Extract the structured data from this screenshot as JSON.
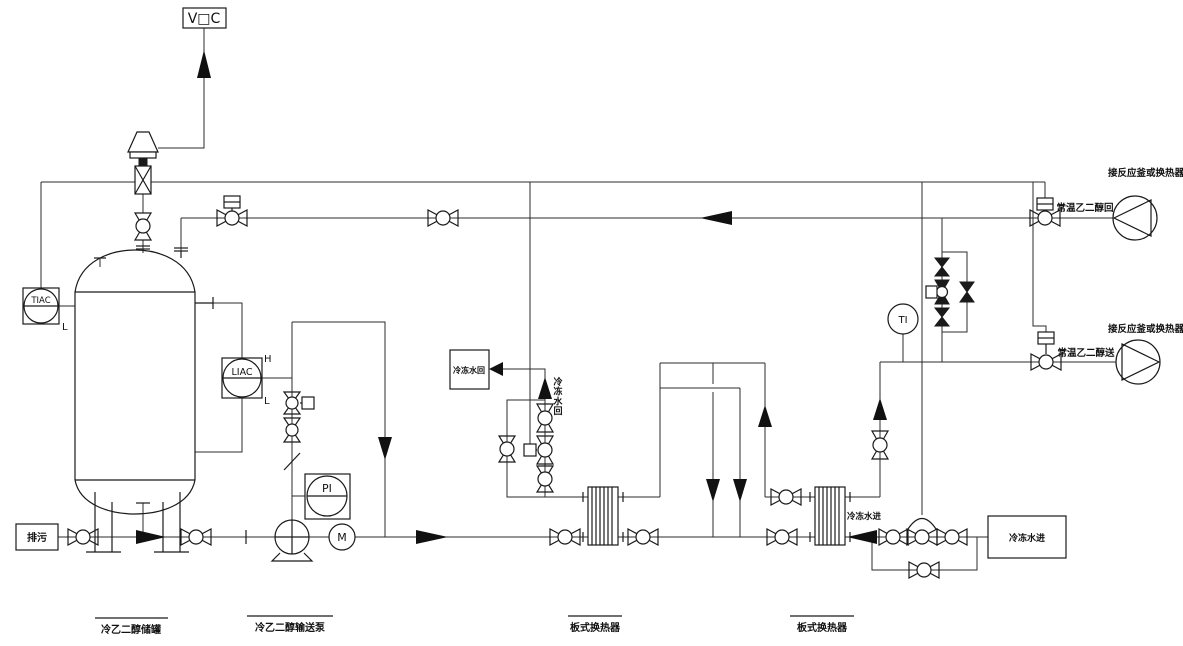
{
  "colors": {
    "line": "#2b2b2b",
    "symbol": "#1a1a1a",
    "background": "#ffffff"
  },
  "vent": {
    "label": "V□C"
  },
  "instruments": {
    "tiac": {
      "tag": "TIAC",
      "low": "L"
    },
    "liac": {
      "tag": "LIAC",
      "high": "H",
      "low": "L"
    },
    "pi": {
      "tag": "PI"
    },
    "motor": {
      "tag": "M"
    },
    "ti": {
      "tag": "TI"
    }
  },
  "streams": {
    "drain": "排污",
    "chilled_return_box": "冷冻水回",
    "chilled_return_riser": "冷冻水回",
    "chilled_in_line": "冷冻水进",
    "chilled_in_box": "冷冻水进",
    "warm_glycol_return": "常温乙二醇回",
    "warm_glycol_supply": "常温乙二醇送",
    "reactor_note_return": "接反应釜或换热器",
    "reactor_note_supply": "接反应釜或换热器"
  },
  "equipment": {
    "tank": "冷乙二醇储罐",
    "pump": "冷乙二醇输送泵",
    "hx1": "板式换热器",
    "hx2": "板式换热器"
  }
}
